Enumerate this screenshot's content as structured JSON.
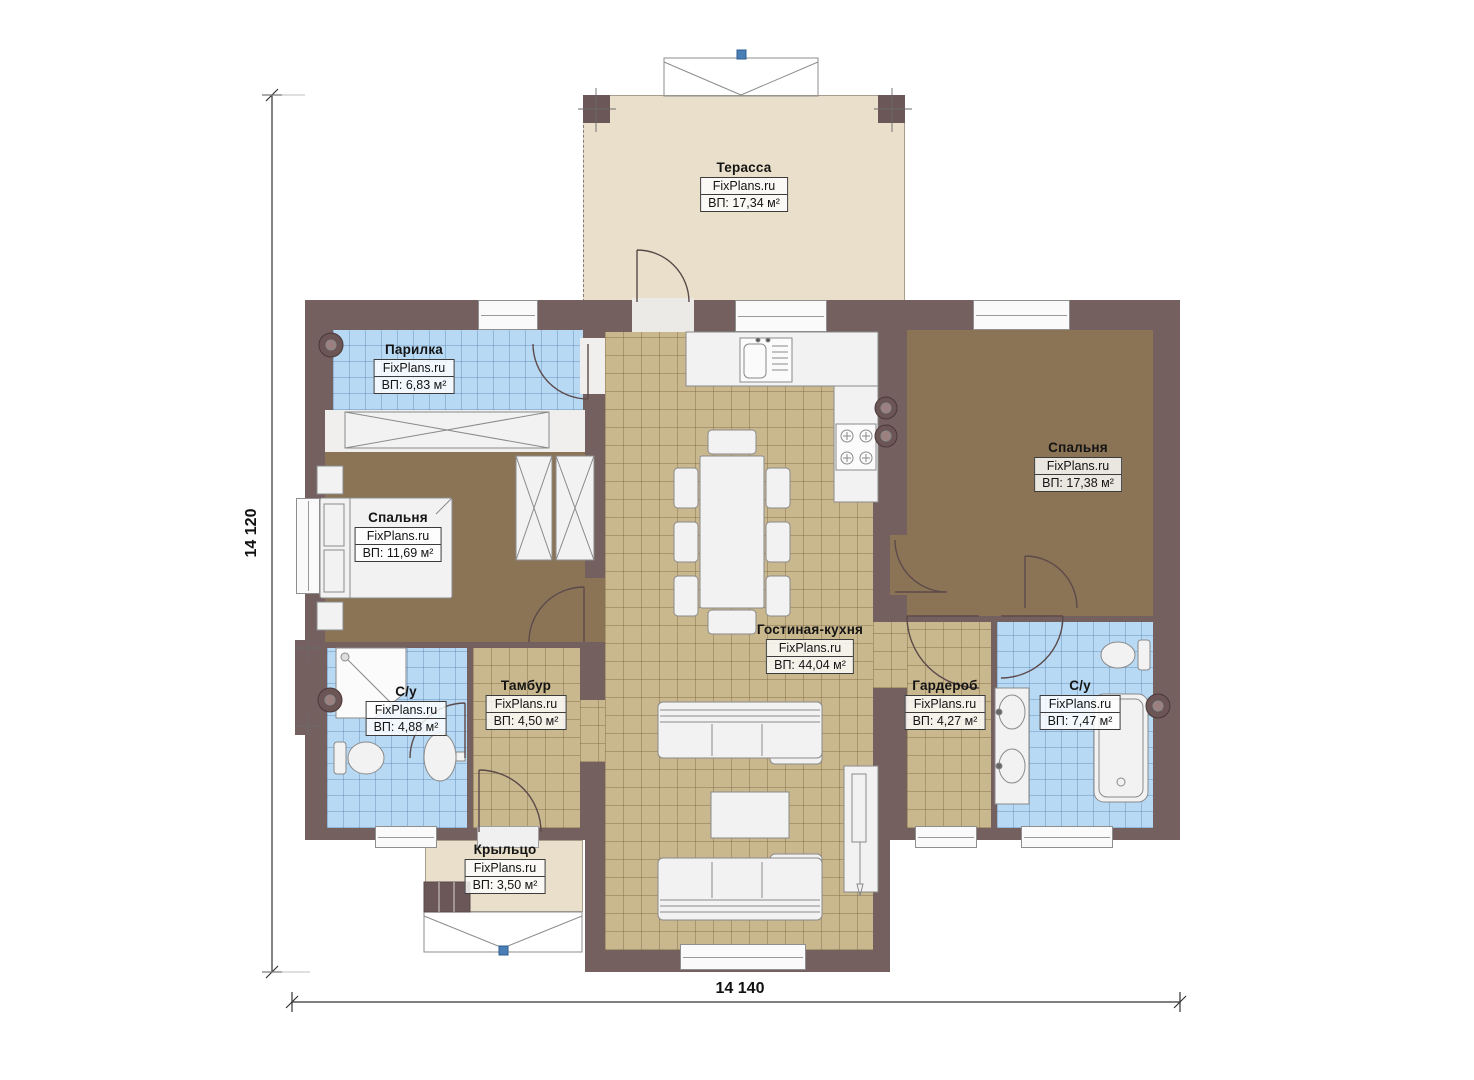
{
  "plan": {
    "brand": "FixPlans.ru",
    "dimensions": {
      "height_label": "14 120",
      "width_label": "14 140"
    },
    "rooms": {
      "terrace": {
        "name": "Терасса",
        "area": "ВП: 17,34 м²"
      },
      "steam_room": {
        "name": "Парилка",
        "area": "ВП: 6,83 м²"
      },
      "bedroom_left": {
        "name": "Спальня",
        "area": "ВП: 11,69 м²"
      },
      "bathroom_left": {
        "name": "С/у",
        "area": "ВП: 4,88 м²"
      },
      "tambour": {
        "name": "Тамбур",
        "area": "ВП: 4,50 м²"
      },
      "living_kitchen": {
        "name": "Гостиная-кухня",
        "area": "ВП: 44,04 м²"
      },
      "bedroom_right": {
        "name": "Спальня",
        "area": "ВП: 17,38 м²"
      },
      "wardrobe": {
        "name": "Гардероб",
        "area": "ВП: 4,27 м²"
      },
      "bathroom_right": {
        "name": "С/у",
        "area": "ВП: 7,47 м²"
      },
      "porch": {
        "name": "Крыльцо",
        "area": "ВП: 3,50 м²"
      }
    },
    "colors": {
      "wall": "#756060",
      "wood_floor": "#8b7456",
      "tile_tan": "#c9b78d",
      "tile_blue": "#b7d9f4",
      "terrace_floor": "#e9dfca",
      "furniture": "#f2f2f2"
    }
  }
}
